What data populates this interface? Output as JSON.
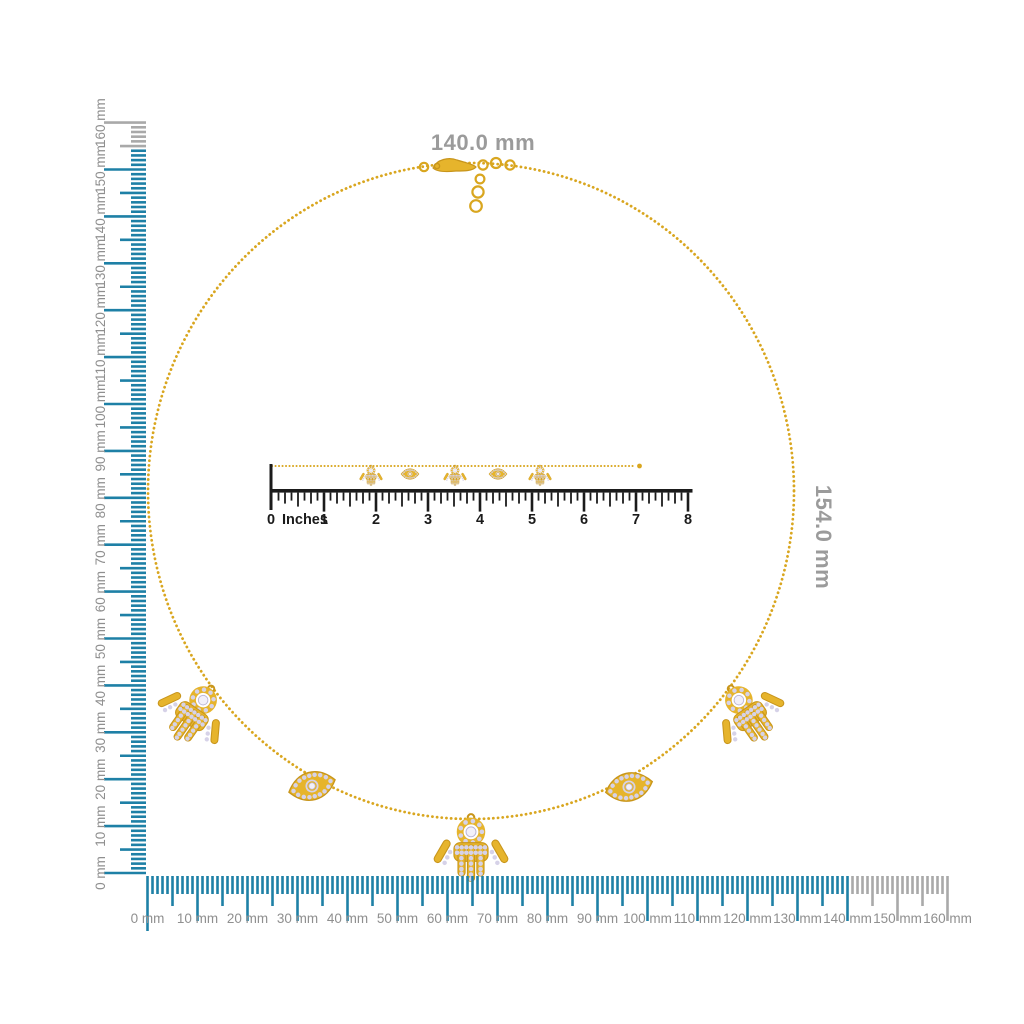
{
  "figure": {
    "background": "#ffffff",
    "subject": "gold necklace with hamsa and evil-eye charms shown with measurement rulers"
  },
  "dimension_labels": {
    "width": "140.0 mm",
    "height": "154.0 mm",
    "color": "#9b9b9b"
  },
  "rulers": {
    "vertical_mm": {
      "unit": "mm",
      "min": 0,
      "max": 160,
      "label_step": 10,
      "active_until": 154,
      "active_color": "#1e80a6",
      "inactive_color": "#a9a9a9",
      "label_color": "#8f8f8f",
      "labels": [
        "0 mm",
        "10 mm",
        "20 mm",
        "30 mm",
        "40 mm",
        "50 mm",
        "60 mm",
        "70 mm",
        "80 mm",
        "90 mm",
        "100 mm",
        "110 mm",
        "120 mm",
        "130 mm",
        "140 mm",
        "150 mm",
        "160 mm"
      ]
    },
    "horizontal_mm": {
      "unit": "mm",
      "min": 0,
      "max": 160,
      "label_step": 10,
      "active_until": 140,
      "active_color": "#1e80a6",
      "inactive_color": "#a9a9a9",
      "label_color": "#8f8f8f",
      "labels": [
        "0 mm",
        "10 mm",
        "20 mm",
        "30 mm",
        "40 mm",
        "50 mm",
        "60 mm",
        "70 mm",
        "80 mm",
        "90 mm",
        "100 mm",
        "110 mm",
        "120 mm",
        "130 mm",
        "140 mm",
        "150 mm",
        "160 mm"
      ]
    },
    "inches": {
      "zero_label": "0",
      "unit_label": "Inches",
      "min": 0,
      "max": 8,
      "color": "#1b1b1b",
      "labels": [
        "1",
        "2",
        "3",
        "4",
        "5",
        "6",
        "7",
        "8"
      ]
    }
  },
  "necklace": {
    "chain_color": "#d9a61f",
    "gold_fill": "#e6b42c",
    "gold_stroke": "#c8951b",
    "stone_color": "#d6d2e8",
    "stone_highlight": "#f2f0f9",
    "stone_edge": "#b9b3d4",
    "circle_charms": [
      {
        "type": "hamsa",
        "x": 213,
        "y": 686,
        "rotate": 35,
        "scale": 1.5
      },
      {
        "type": "evil-eye",
        "x": 312,
        "y": 786,
        "rotate": -15,
        "scale": 1.45
      },
      {
        "type": "hamsa",
        "x": 471,
        "y": 814,
        "rotate": 0,
        "scale": 1.55
      },
      {
        "type": "evil-eye",
        "x": 629,
        "y": 787,
        "rotate": -13,
        "scale": 1.45
      },
      {
        "type": "hamsa",
        "x": 729,
        "y": 686,
        "rotate": -35,
        "scale": 1.5
      }
    ],
    "strand_charms": [
      {
        "type": "hamsa",
        "x": 371,
        "y": 465,
        "rotate": 0,
        "scale": 0.48
      },
      {
        "type": "evil-eye",
        "x": 410,
        "y": 474,
        "rotate": 0,
        "scale": 0.55
      },
      {
        "type": "hamsa",
        "x": 455,
        "y": 465,
        "rotate": 0,
        "scale": 0.48
      },
      {
        "type": "evil-eye",
        "x": 498,
        "y": 474,
        "rotate": 0,
        "scale": 0.55
      },
      {
        "type": "hamsa",
        "x": 540,
        "y": 465,
        "rotate": 0,
        "scale": 0.48
      }
    ]
  }
}
